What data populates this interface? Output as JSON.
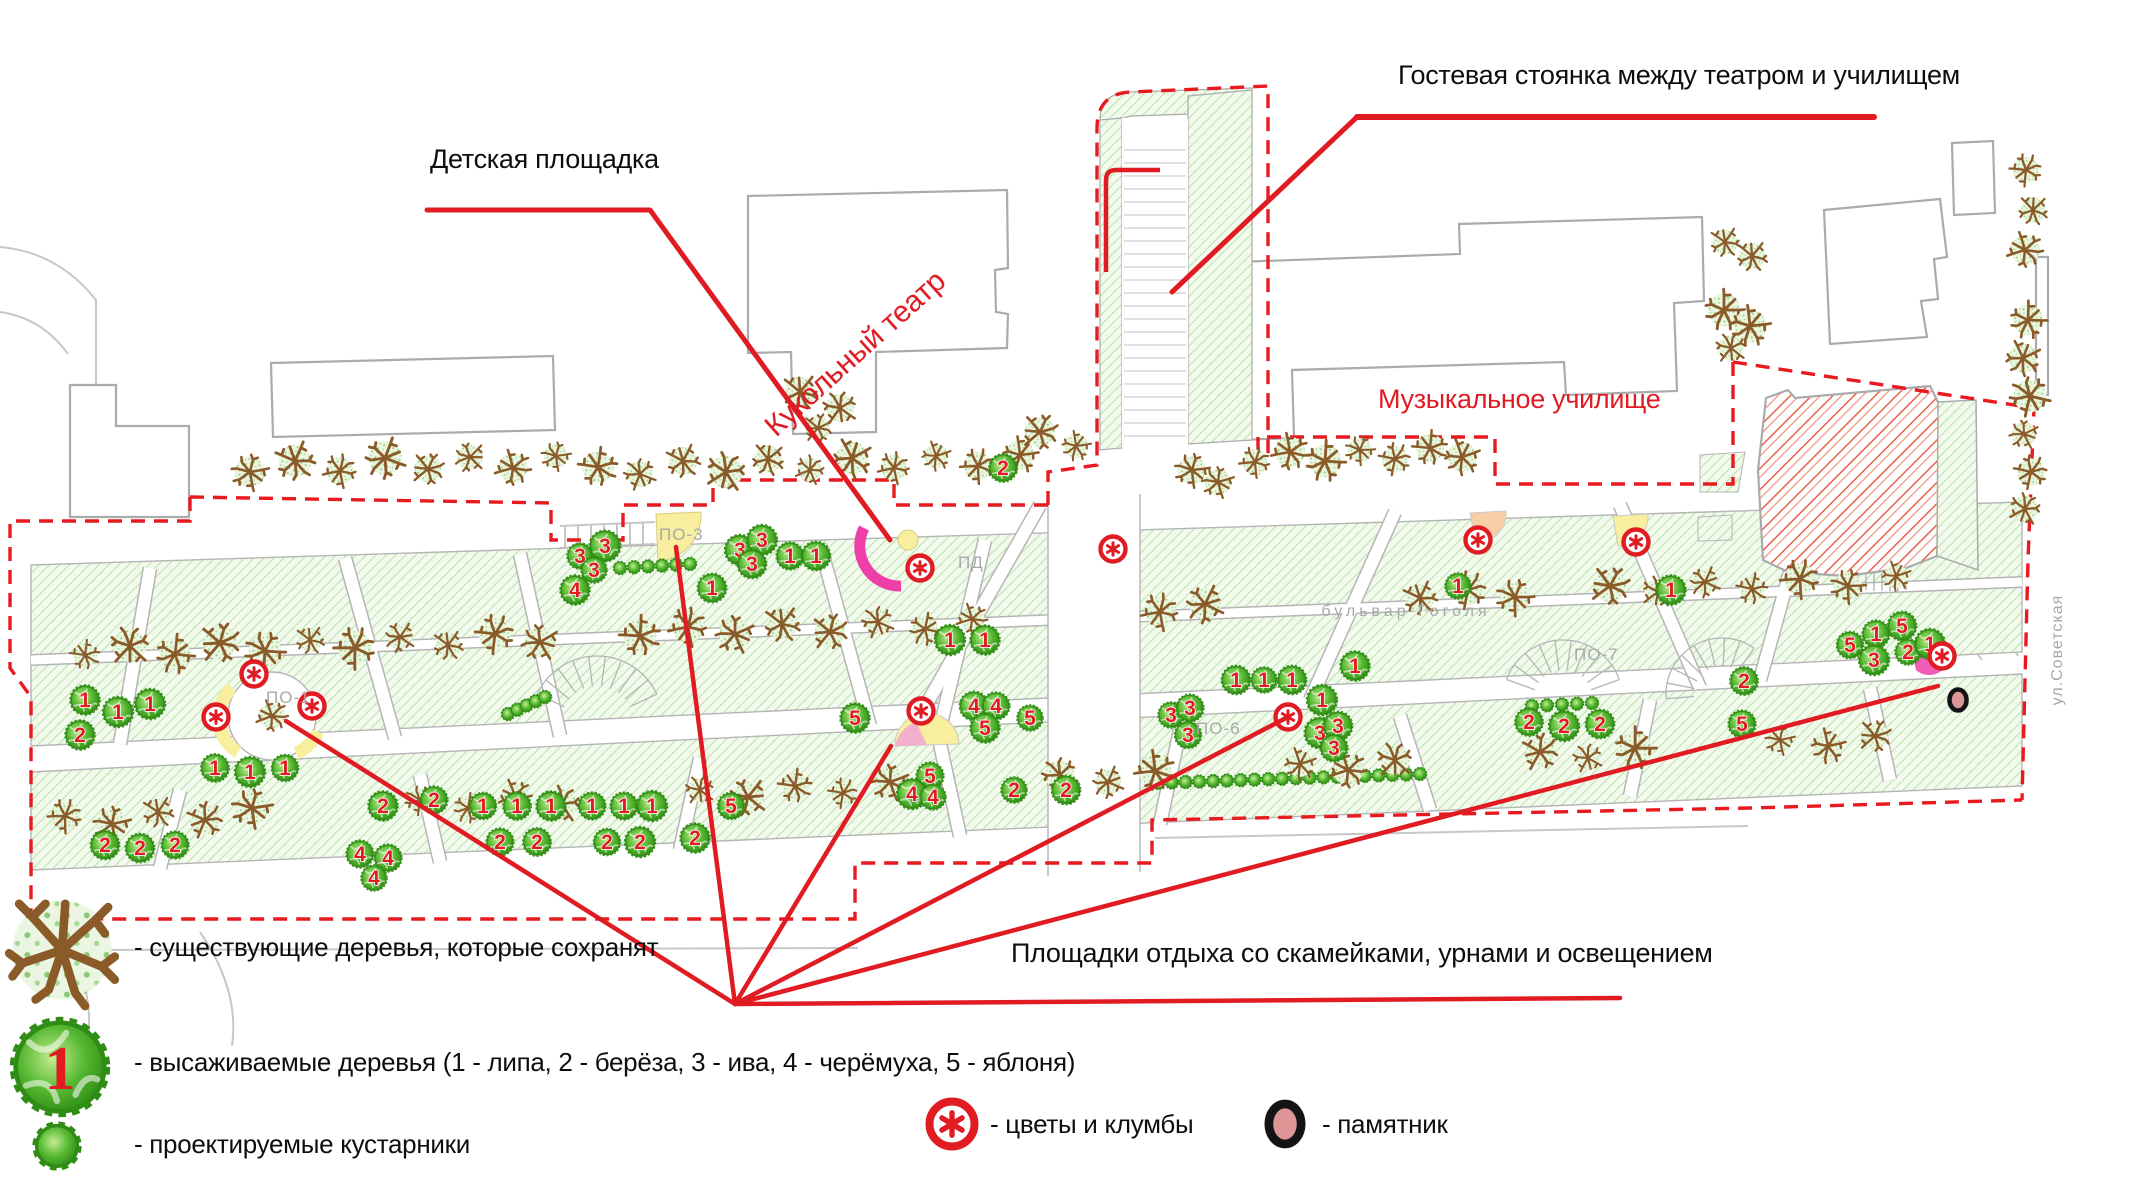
{
  "colors": {
    "annotation_red": "#e01b22",
    "green_area_fill": "#f1faec",
    "green_hatch": "#a4d88e",
    "planted_tree_green": "#57b832",
    "planted_tree_dark": "#2f8c14",
    "existing_tree_brown": "#8a5a28",
    "building_stroke": "#ababab",
    "playground_pink": "#ee3fa8",
    "restarea_yellow": "#f7ee9e",
    "flowerbed_peach": "#f6cfa8",
    "monument_fill": "#dd9596",
    "street_text_gray": "#a8a8a8",
    "demolish_hatch_red": "#e8604a"
  },
  "labels": {
    "playground": "Детская площадка",
    "guest_parking": "Гостевая стоянка между театром и училищем",
    "puppet_theater": "Кукольный театр",
    "music_college": "Музыкальное училище",
    "rest_areas": "Площадки отдыха со скамейками, урнами и освещением"
  },
  "plan": {
    "area_codes": [
      {
        "text": "ПО-1",
        "x": 266,
        "y": 703
      },
      {
        "text": "ПО-3",
        "x": 659,
        "y": 540
      },
      {
        "text": "ПД",
        "x": 958,
        "y": 568
      },
      {
        "text": "ПО-6",
        "x": 1196,
        "y": 734
      },
      {
        "text": "ПО-7",
        "x": 1574,
        "y": 660
      }
    ],
    "streets": [
      {
        "text": "бульвар Гоголя",
        "x": 1406,
        "y": 616,
        "rotation": 0,
        "letter_spacing": 4
      },
      {
        "text": "ул.Советская",
        "x": 2062,
        "y": 650,
        "rotation": -90,
        "letter_spacing": 1
      }
    ],
    "species_key": {
      "1": "липа",
      "2": "берёза",
      "3": "ива",
      "4": "черёмуха",
      "5": "яблоня"
    },
    "existing_trees": [
      [
        250,
        472
      ],
      [
        295,
        461
      ],
      [
        340,
        471
      ],
      [
        385,
        458
      ],
      [
        428,
        469
      ],
      [
        470,
        457
      ],
      [
        513,
        468
      ],
      [
        556,
        456
      ],
      [
        598,
        467
      ],
      [
        640,
        474
      ],
      [
        683,
        461
      ],
      [
        726,
        472
      ],
      [
        768,
        459
      ],
      [
        810,
        470
      ],
      [
        852,
        458
      ],
      [
        894,
        468
      ],
      [
        936,
        456
      ],
      [
        978,
        466
      ],
      [
        1020,
        455
      ],
      [
        1255,
        462
      ],
      [
        1290,
        452
      ],
      [
        1325,
        461
      ],
      [
        1360,
        450
      ],
      [
        1395,
        459
      ],
      [
        1430,
        448
      ],
      [
        1462,
        457
      ],
      [
        1725,
        242
      ],
      [
        1752,
        256
      ],
      [
        1724,
        310
      ],
      [
        1750,
        326
      ],
      [
        1731,
        348
      ],
      [
        2028,
        320
      ],
      [
        2023,
        358
      ],
      [
        2030,
        396
      ],
      [
        2024,
        434
      ],
      [
        2031,
        472
      ],
      [
        2025,
        509
      ],
      [
        2026,
        170
      ],
      [
        2033,
        210
      ],
      [
        2025,
        250
      ],
      [
        800,
        392
      ],
      [
        840,
        408
      ],
      [
        818,
        428
      ],
      [
        1040,
        432
      ],
      [
        1076,
        446
      ],
      [
        1192,
        470
      ],
      [
        1218,
        482
      ],
      [
        272,
        716
      ],
      [
        85,
        655
      ],
      [
        130,
        646
      ],
      [
        175,
        654
      ],
      [
        220,
        643
      ],
      [
        265,
        651
      ],
      [
        310,
        640
      ],
      [
        355,
        648
      ],
      [
        400,
        637
      ],
      [
        448,
        645
      ],
      [
        495,
        634
      ],
      [
        540,
        642
      ],
      [
        640,
        636
      ],
      [
        688,
        627
      ],
      [
        735,
        634
      ],
      [
        782,
        624
      ],
      [
        830,
        632
      ],
      [
        878,
        622
      ],
      [
        925,
        629
      ],
      [
        972,
        619
      ],
      [
        1160,
        612
      ],
      [
        1205,
        604
      ],
      [
        1420,
        598
      ],
      [
        1468,
        590
      ],
      [
        1515,
        597
      ],
      [
        1610,
        586
      ],
      [
        1658,
        592
      ],
      [
        1705,
        582
      ],
      [
        1752,
        589
      ],
      [
        1800,
        579
      ],
      [
        1848,
        586
      ],
      [
        1896,
        576
      ],
      [
        65,
        816
      ],
      [
        112,
        824
      ],
      [
        158,
        812
      ],
      [
        205,
        820
      ],
      [
        252,
        808
      ],
      [
        420,
        800
      ],
      [
        468,
        808
      ],
      [
        515,
        796
      ],
      [
        562,
        804
      ],
      [
        700,
        790
      ],
      [
        748,
        797
      ],
      [
        795,
        786
      ],
      [
        843,
        793
      ],
      [
        890,
        782
      ],
      [
        1060,
        775
      ],
      [
        1108,
        782
      ],
      [
        1155,
        771
      ],
      [
        1300,
        764
      ],
      [
        1348,
        770
      ],
      [
        1395,
        760
      ],
      [
        1540,
        752
      ],
      [
        1588,
        758
      ],
      [
        1635,
        748
      ],
      [
        1780,
        740
      ],
      [
        1828,
        746
      ],
      [
        1875,
        736
      ]
    ],
    "planted_trees": [
      [
        85,
        700,
        "1"
      ],
      [
        118,
        712,
        "1"
      ],
      [
        150,
        704,
        "1"
      ],
      [
        80,
        735,
        "2"
      ],
      [
        215,
        768,
        "1"
      ],
      [
        250,
        772,
        "1"
      ],
      [
        285,
        768,
        "1"
      ],
      [
        105,
        845,
        "2"
      ],
      [
        140,
        848,
        "2"
      ],
      [
        175,
        845,
        "2"
      ],
      [
        360,
        854,
        "4"
      ],
      [
        388,
        858,
        "4"
      ],
      [
        374,
        878,
        "4"
      ],
      [
        580,
        556,
        "3"
      ],
      [
        605,
        546,
        "3"
      ],
      [
        594,
        570,
        "3"
      ],
      [
        575,
        590,
        "4"
      ],
      [
        740,
        550,
        "3"
      ],
      [
        762,
        540,
        "3"
      ],
      [
        752,
        564,
        "3"
      ],
      [
        790,
        556,
        "1"
      ],
      [
        816,
        556,
        "1"
      ],
      [
        712,
        588,
        "1"
      ],
      [
        383,
        806,
        "2"
      ],
      [
        434,
        800,
        "2"
      ],
      [
        483,
        806,
        "1"
      ],
      [
        517,
        806,
        "1"
      ],
      [
        551,
        806,
        "1"
      ],
      [
        500,
        842,
        "2"
      ],
      [
        537,
        842,
        "2"
      ],
      [
        592,
        806,
        "1"
      ],
      [
        624,
        806,
        "1"
      ],
      [
        652,
        806,
        "1"
      ],
      [
        607,
        842,
        "2"
      ],
      [
        640,
        842,
        "2"
      ],
      [
        731,
        806,
        "5"
      ],
      [
        695,
        838,
        "2"
      ],
      [
        855,
        718,
        "5"
      ],
      [
        974,
        706,
        "4"
      ],
      [
        996,
        706,
        "4"
      ],
      [
        985,
        728,
        "5"
      ],
      [
        1030,
        718,
        "5"
      ],
      [
        930,
        776,
        "5"
      ],
      [
        912,
        794,
        "4"
      ],
      [
        933,
        797,
        "4"
      ],
      [
        1014,
        790,
        "2"
      ],
      [
        1066,
        790,
        "2"
      ],
      [
        950,
        640,
        "1"
      ],
      [
        985,
        640,
        "1"
      ],
      [
        1003,
        468,
        "2"
      ],
      [
        1236,
        680,
        "1"
      ],
      [
        1264,
        680,
        "1"
      ],
      [
        1292,
        680,
        "1"
      ],
      [
        1322,
        700,
        "1"
      ],
      [
        1355,
        666,
        "1"
      ],
      [
        1171,
        715,
        "3"
      ],
      [
        1190,
        708,
        "3"
      ],
      [
        1188,
        735,
        "3"
      ],
      [
        1320,
        733,
        "3"
      ],
      [
        1338,
        726,
        "3"
      ],
      [
        1334,
        748,
        "3"
      ],
      [
        1458,
        586,
        "1"
      ],
      [
        1529,
        722,
        "2"
      ],
      [
        1564,
        726,
        "2"
      ],
      [
        1600,
        724,
        "2"
      ],
      [
        1671,
        590,
        "1"
      ],
      [
        1742,
        724,
        "5"
      ],
      [
        1744,
        681,
        "2"
      ],
      [
        1850,
        645,
        "5"
      ],
      [
        1876,
        634,
        "1"
      ],
      [
        1902,
        626,
        "5"
      ],
      [
        1874,
        660,
        "3"
      ],
      [
        1908,
        652,
        "2"
      ],
      [
        1930,
        644,
        "1"
      ]
    ],
    "shrub_rows": [
      {
        "x1": 1158,
        "y1": 783,
        "x2": 1420,
        "y2": 774,
        "count": 20
      },
      {
        "x1": 620,
        "y1": 568,
        "x2": 690,
        "y2": 564,
        "count": 6
      },
      {
        "x1": 1532,
        "y1": 706,
        "x2": 1592,
        "y2": 703,
        "count": 5
      },
      {
        "x1": 508,
        "y1": 714,
        "x2": 545,
        "y2": 697,
        "count": 5
      }
    ],
    "flower_beds": [
      [
        216,
        717
      ],
      [
        254,
        674
      ],
      [
        312,
        706
      ],
      [
        920,
        568
      ],
      [
        921,
        711
      ],
      [
        1113,
        549
      ],
      [
        1288,
        717
      ],
      [
        1478,
        540
      ],
      [
        1636,
        542
      ],
      [
        1942,
        656
      ]
    ],
    "monument": [
      1958,
      700
    ]
  },
  "annotations": {
    "playground": {
      "label_x": 430,
      "label_y": 146,
      "leader": [
        [
          427,
          210
        ],
        [
          650,
          210
        ],
        [
          890,
          540
        ]
      ]
    },
    "guest_parking": {
      "label_x": 1398,
      "label_y": 62,
      "underline": [
        [
          1357,
          117
        ],
        [
          1874,
          117
        ]
      ],
      "leader": [
        [
          1357,
          117
        ],
        [
          1172,
          292
        ]
      ]
    },
    "puppet_theater": {
      "x": 760,
      "y": 420,
      "rotation": -42
    },
    "music_college": {
      "x": 1378,
      "y": 386
    },
    "rest_areas": {
      "label_x": 1011,
      "label_y": 940,
      "convergence": [
        735,
        1004
      ],
      "targets": [
        [
          286,
          721
        ],
        [
          676,
          547
        ],
        [
          891,
          746
        ],
        [
          1288,
          717
        ],
        [
          1938,
          686
        ],
        [
          1620,
          998
        ]
      ]
    }
  },
  "legend": {
    "items": [
      {
        "icon": "existing-tree-icon",
        "text": "- существующие деревья, которые сохранят",
        "icon_x": 62,
        "icon_y": 950,
        "text_x": 134,
        "text_y": 934
      },
      {
        "icon": "planted-tree-icon",
        "badge": "1",
        "text": "- высаживаемые деревья (1 - липа, 2 - берёза, 3 - ива, 4 - черёмуха, 5 - яблоня)",
        "icon_x": 60,
        "icon_y": 1067,
        "text_x": 134,
        "text_y": 1049
      },
      {
        "icon": "shrub-icon",
        "text": "- проектируемые кустарники",
        "icon_x": 57,
        "icon_y": 1146,
        "text_x": 134,
        "text_y": 1131
      },
      {
        "icon": "flower-icon",
        "text": "- цветы и клумбы",
        "icon_x": 952,
        "icon_y": 1124,
        "text_x": 990,
        "text_y": 1111
      },
      {
        "icon": "monument-icon",
        "text": "- памятник",
        "icon_x": 1285,
        "icon_y": 1124,
        "text_x": 1322,
        "text_y": 1111
      }
    ]
  }
}
